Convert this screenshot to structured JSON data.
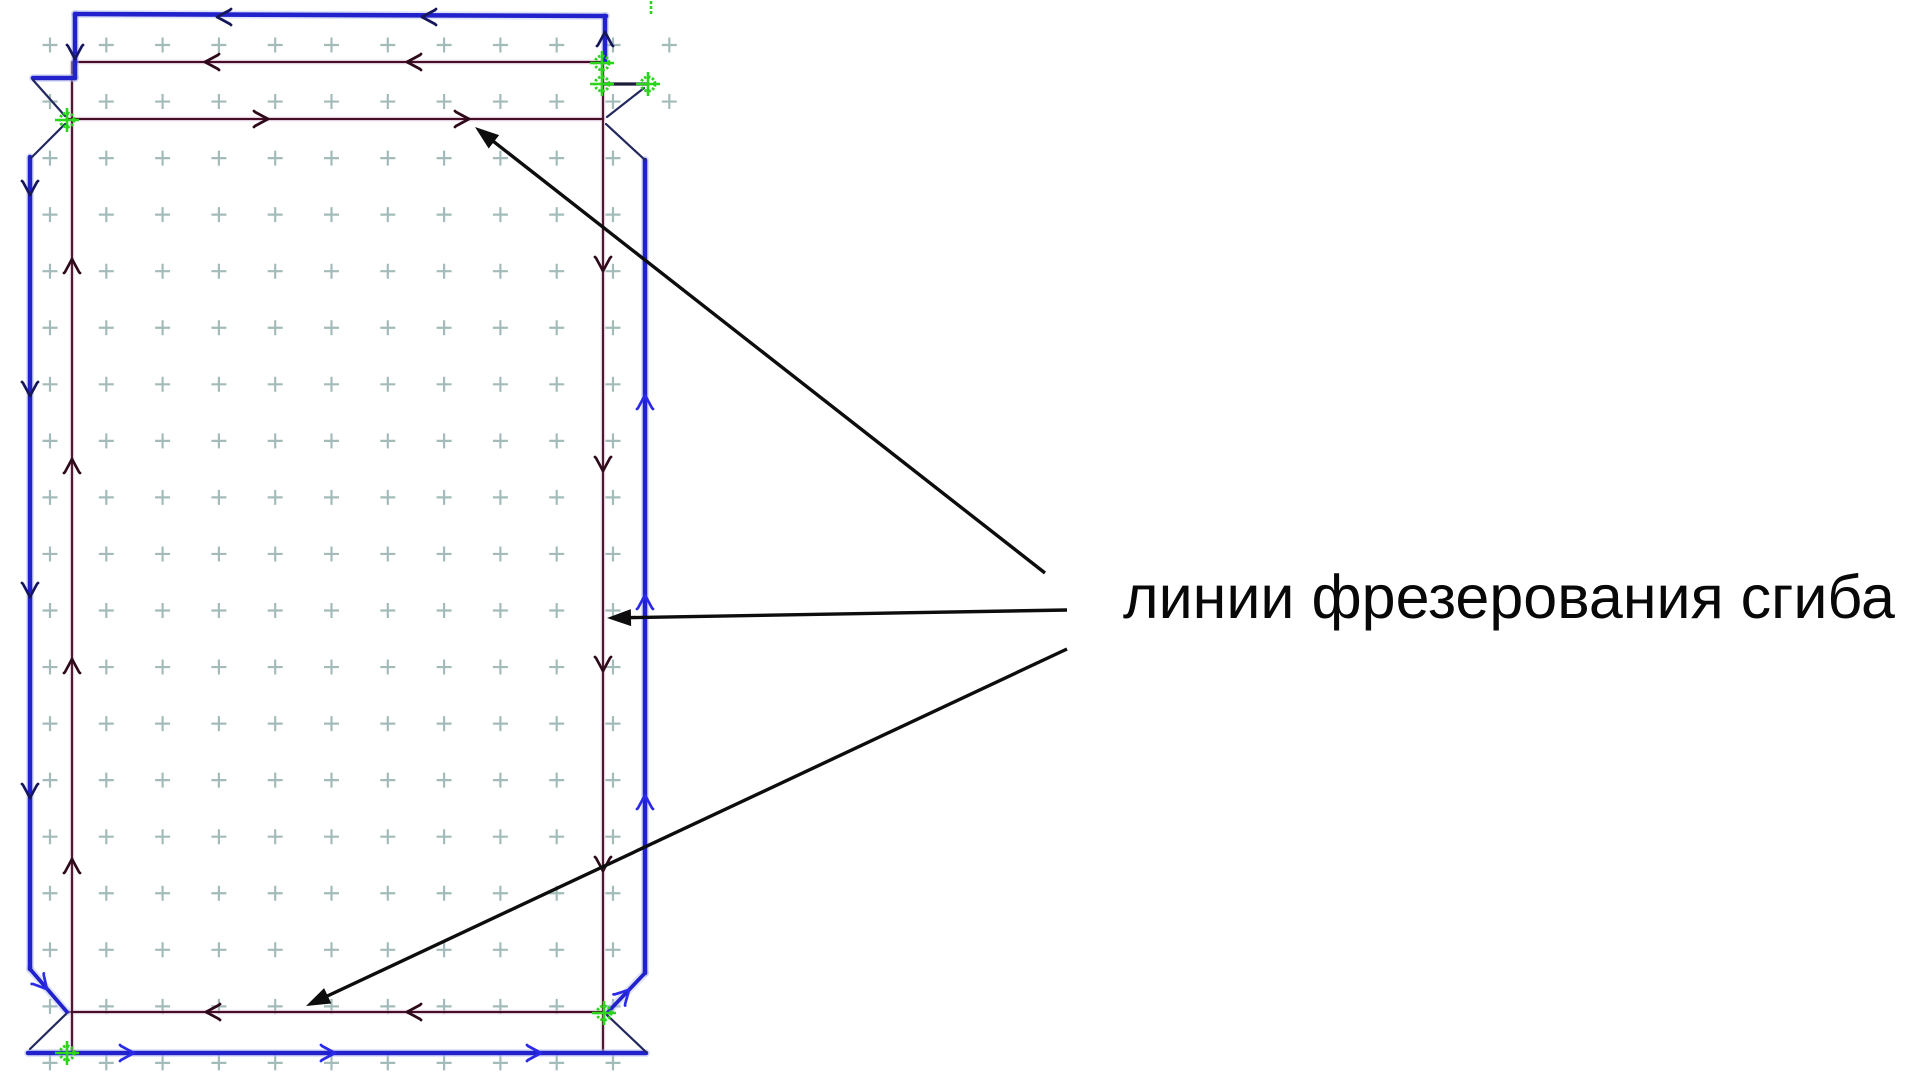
{
  "label": {
    "text": "линии фрезерования сгиба",
    "x": 1123,
    "y_top": 567,
    "font_size": 61,
    "color": "#080808"
  },
  "diagram": {
    "canvas": {
      "width": 1920,
      "height": 1077,
      "background": "#ffffff"
    },
    "styles": {
      "blue_thick": {
        "stroke": "#2222cd",
        "width": 4.6
      },
      "blue_halo": {
        "stroke": "#b9c2ee",
        "width": 8,
        "opacity": 0.45
      },
      "blue_med": {
        "stroke": "#2222cd",
        "width": 3.8
      },
      "navy_thin": {
        "stroke": "#23285e",
        "width": 2.2
      },
      "link_dark": {
        "stroke": "#1c1c3a",
        "width": 3.2
      },
      "maroon_core": {
        "stroke": "#451027",
        "width": 1.9
      },
      "maroon_halo": {
        "stroke": "#c9a0c2",
        "width": 4.4,
        "opacity": 0.5
      },
      "chevron_navy": "#16165c",
      "chevron_blue": "#2a2ae8",
      "chevron_maroon": "#2e0a1a",
      "marker_green": "#2dd41e",
      "arrow_black": "#0d0d0d",
      "grid": "#a3bcba"
    },
    "grid": {
      "x0": 50,
      "dx": 56.3,
      "y0": 45,
      "dy": 56.55,
      "rows": 19,
      "cols_default": 11,
      "cols_top": 12,
      "top_rows": 2,
      "arm": 7.5,
      "stroke_width": 2.2
    },
    "outer_contour_lines": [
      {
        "p": [
          75,
          14,
          606,
          16
        ],
        "s": "blue_thick"
      },
      {
        "p": [
          75,
          14,
          75,
          78
        ],
        "s": "blue_thick"
      },
      {
        "p": [
          75,
          78,
          33,
          78
        ],
        "s": "blue_thick"
      },
      {
        "p": [
          30,
          157,
          30,
          969
        ],
        "s": "blue_thick"
      },
      {
        "p": [
          30,
          969,
          67,
          1012
        ],
        "s": "blue_med"
      },
      {
        "p": [
          28,
          1053,
          646,
          1053
        ],
        "s": "blue_thick"
      },
      {
        "p": [
          645,
          973,
          607,
          1013
        ],
        "s": "blue_med"
      },
      {
        "p": [
          645,
          160,
          645,
          973
        ],
        "s": "blue_thick"
      },
      {
        "p": [
          605,
          16,
          605,
          61
        ],
        "s": "blue_thick"
      }
    ],
    "aux_lines": [
      {
        "p": [
          33,
          80,
          65,
          116
        ],
        "s": "navy_thin"
      },
      {
        "p": [
          65,
          124,
          31,
          158
        ],
        "s": "navy_thin"
      },
      {
        "p": [
          66,
          1014,
          30,
          1049
        ],
        "s": "navy_thin"
      },
      {
        "p": [
          607,
          1015,
          646,
          1052
        ],
        "s": "navy_thin"
      },
      {
        "p": [
          606,
          124,
          645,
          160
        ],
        "s": "navy_thin"
      },
      {
        "p": [
          607,
          117,
          644,
          88
        ],
        "s": "navy_thin"
      },
      {
        "p": [
          604,
          84,
          648,
          84
        ],
        "s": "link_dark"
      }
    ],
    "bend_milling_lines": [
      {
        "p": [
          74,
          62,
          603,
          62
        ]
      },
      {
        "p": [
          67,
          119,
          603,
          119
        ]
      },
      {
        "p": [
          67,
          1012,
          603,
          1012
        ]
      },
      {
        "p": [
          72,
          62,
          72,
          1052
        ]
      },
      {
        "p": [
          603,
          62,
          603,
          1052
        ]
      }
    ],
    "chevrons": [
      {
        "x": 220,
        "y": 17,
        "a": 180,
        "c": "chevron_navy"
      },
      {
        "x": 425,
        "y": 17,
        "a": 180,
        "c": "chevron_navy"
      },
      {
        "x": 75,
        "y": 56,
        "a": 90,
        "c": "chevron_navy"
      },
      {
        "x": 605,
        "y": 35,
        "a": -90,
        "c": "chevron_navy"
      },
      {
        "x": 30,
        "y": 192,
        "a": 90,
        "c": "chevron_navy"
      },
      {
        "x": 30,
        "y": 393,
        "a": 90,
        "c": "chevron_navy"
      },
      {
        "x": 30,
        "y": 594,
        "a": 90,
        "c": "chevron_navy"
      },
      {
        "x": 30,
        "y": 795,
        "a": 90,
        "c": "chevron_navy"
      },
      {
        "x": 45,
        "y": 987,
        "a": 49,
        "c": "chevron_blue"
      },
      {
        "x": 131,
        "y": 1053,
        "a": 0,
        "c": "chevron_blue"
      },
      {
        "x": 332,
        "y": 1053,
        "a": 0,
        "c": "chevron_blue"
      },
      {
        "x": 538,
        "y": 1053,
        "a": 0,
        "c": "chevron_blue"
      },
      {
        "x": 627,
        "y": 992,
        "a": -46,
        "c": "chevron_blue"
      },
      {
        "x": 645,
        "y": 398,
        "a": -90,
        "c": "chevron_blue"
      },
      {
        "x": 645,
        "y": 598,
        "a": -90,
        "c": "chevron_blue"
      },
      {
        "x": 645,
        "y": 798,
        "a": -90,
        "c": "chevron_blue"
      },
      {
        "x": 208,
        "y": 62,
        "a": 180,
        "c": "chevron_maroon"
      },
      {
        "x": 410,
        "y": 62,
        "a": 180,
        "c": "chevron_maroon"
      },
      {
        "x": 265,
        "y": 119,
        "a": 0,
        "c": "chevron_maroon"
      },
      {
        "x": 466,
        "y": 119,
        "a": 0,
        "c": "chevron_maroon"
      },
      {
        "x": 209,
        "y": 1012,
        "a": 180,
        "c": "chevron_maroon"
      },
      {
        "x": 410,
        "y": 1012,
        "a": 180,
        "c": "chevron_maroon"
      },
      {
        "x": 72,
        "y": 262,
        "a": -90,
        "c": "chevron_maroon"
      },
      {
        "x": 72,
        "y": 462,
        "a": -90,
        "c": "chevron_maroon"
      },
      {
        "x": 72,
        "y": 662,
        "a": -90,
        "c": "chevron_maroon"
      },
      {
        "x": 72,
        "y": 862,
        "a": -90,
        "c": "chevron_maroon"
      },
      {
        "x": 603,
        "y": 268,
        "a": 90,
        "c": "chevron_maroon"
      },
      {
        "x": 603,
        "y": 468,
        "a": 90,
        "c": "chevron_maroon"
      },
      {
        "x": 603,
        "y": 668,
        "a": 90,
        "c": "chevron_maroon"
      },
      {
        "x": 603,
        "y": 868,
        "a": 90,
        "c": "chevron_maroon"
      }
    ],
    "snap_markers": [
      {
        "x": 67,
        "y": 120
      },
      {
        "x": 602,
        "y": 63
      },
      {
        "x": 602,
        "y": 84
      },
      {
        "x": 648,
        "y": 84
      },
      {
        "x": 67,
        "y": 1053
      },
      {
        "x": 604,
        "y": 1013
      }
    ],
    "start_tick": {
      "x": 651,
      "y1": 1,
      "y2": 14
    },
    "annotation_arrows": [
      {
        "tail": [
          1045,
          573
        ],
        "tip": [
          475,
          127
        ]
      },
      {
        "tail": [
          1067,
          610
        ],
        "tip": [
          607,
          618
        ]
      },
      {
        "tail": [
          1067,
          649
        ],
        "tip": [
          306,
          1006
        ]
      }
    ],
    "arrow_head": {
      "length": 24,
      "half_width": 8.5
    }
  }
}
